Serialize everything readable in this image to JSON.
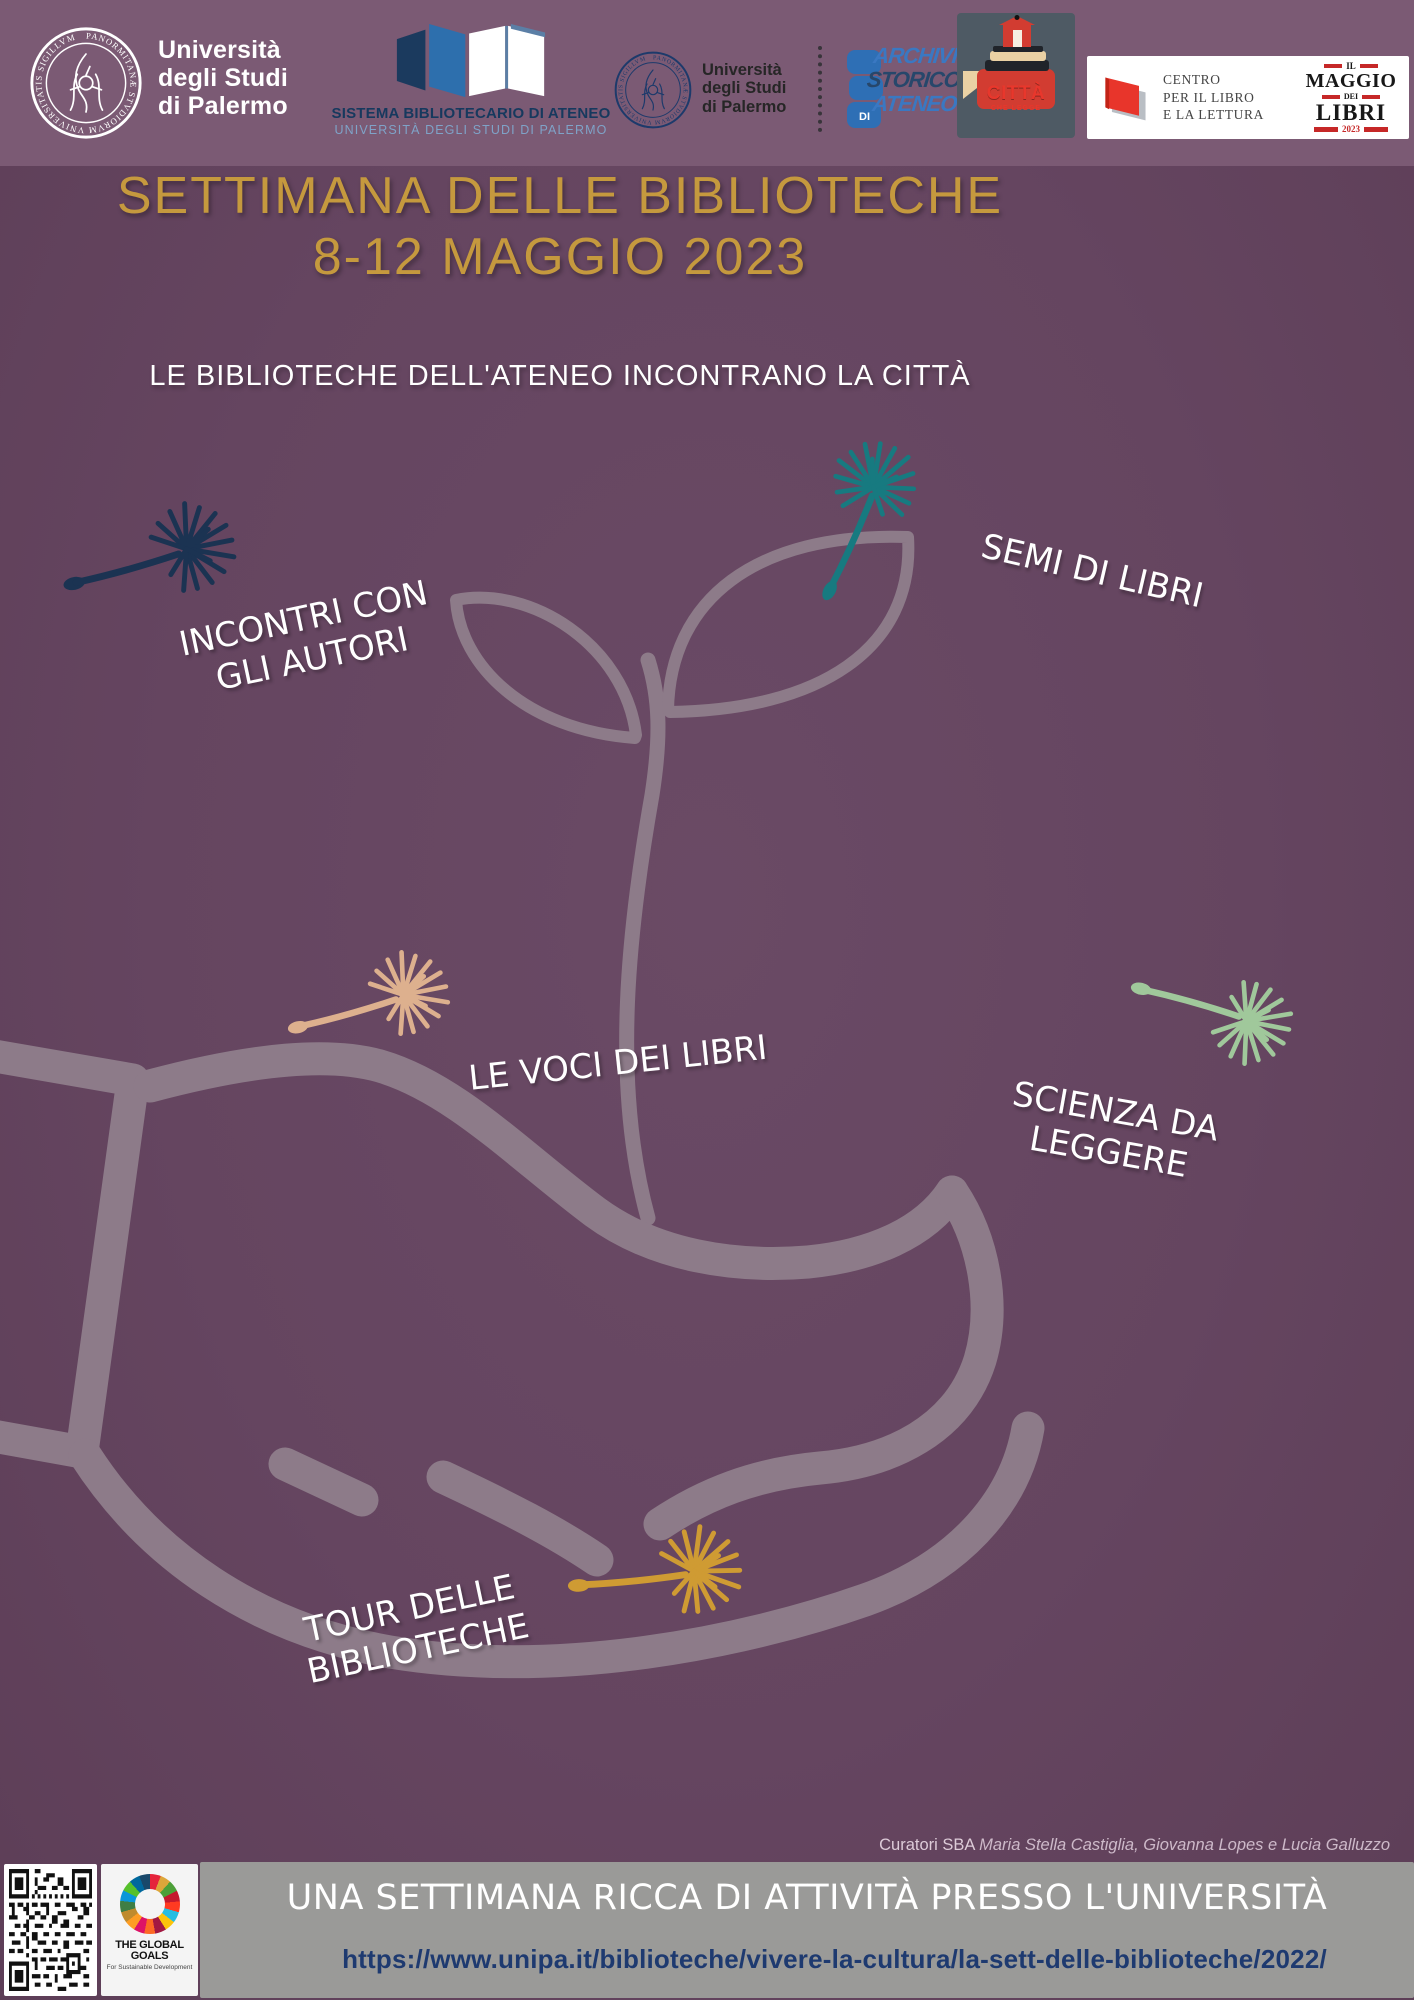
{
  "colors": {
    "header_bg": "#7b5a74",
    "body_bg": "#654560",
    "title_gold": "#c5993e",
    "hand_outline": "#8d7b89",
    "seed_navy": "#1b3352",
    "seed_teal": "#177a80",
    "seed_beige": "#ddb08e",
    "seed_mint": "#a0c89b",
    "seed_gold": "#cf9b33",
    "footer_gray": "#9a9a98",
    "url_navy": "#1e3a70"
  },
  "header": {
    "unipa_seal_text": "PANORMITANÆ STVDIORVM VNIVERSITATIS SIGILLVM",
    "unipa_name": "Università\ndegli Studi\ndi Palermo",
    "sba_line1": "SISTEMA BIBLIOTECARIO DI ATENEO",
    "sba_line2": "UNIVERSITÀ DEGLI STUDI DI PALERMO",
    "unipa2_name": "Università\ndegli Studi\ndi Palermo",
    "archivio_word1": "ARCHIVIO",
    "archivio_word2": "STORICO",
    "archivio_word3": "ATENEO",
    "archivio_di": "DI",
    "citta_title": "CITTÀ",
    "citta_subtitle": "CHE LEGGE",
    "centro_name": "CENTRO\nPER IL LIBRO\nE LA LETTURA",
    "maggio_il": "IL",
    "maggio_word": "MAGGIO",
    "maggio_dei": "DEI",
    "maggio_libri": "LIBRI",
    "maggio_year": "2023"
  },
  "title_line1": "SETTIMANA DELLE BIBLIOTECHE",
  "title_line2": "8-12 MAGGIO 2023",
  "subtitle": "LE BIBLIOTECHE DELL'ATENEO INCONTRANO LA CITTÀ",
  "tags": [
    {
      "label": "INCONTRI CON\nGLI AUTORI"
    },
    {
      "label": "SEMI DI LIBRI"
    },
    {
      "label": "LE VOCI DEI LIBRI"
    },
    {
      "label": "SCIENZA DA\nLEGGERE"
    },
    {
      "label": "TOUR DELLE\nBIBLIOTECHE"
    }
  ],
  "curators_prefix": "Curatori SBA",
  "curators_names": "Maria Stella Castiglia, Giovanna Lopes e Lucia Galluzzo",
  "footer": {
    "headline": "UNA SETTIMANA RICCA DI ATTIVITÀ PRESSO L'UNIVERSITÀ",
    "url": "https://www.unipa.it/biblioteche/vivere-la-cultura/la-sett-delle-biblioteche/2022/",
    "global_goals_title": "THE GLOBAL GOALS",
    "global_goals_subtitle": "For Sustainable Development"
  }
}
